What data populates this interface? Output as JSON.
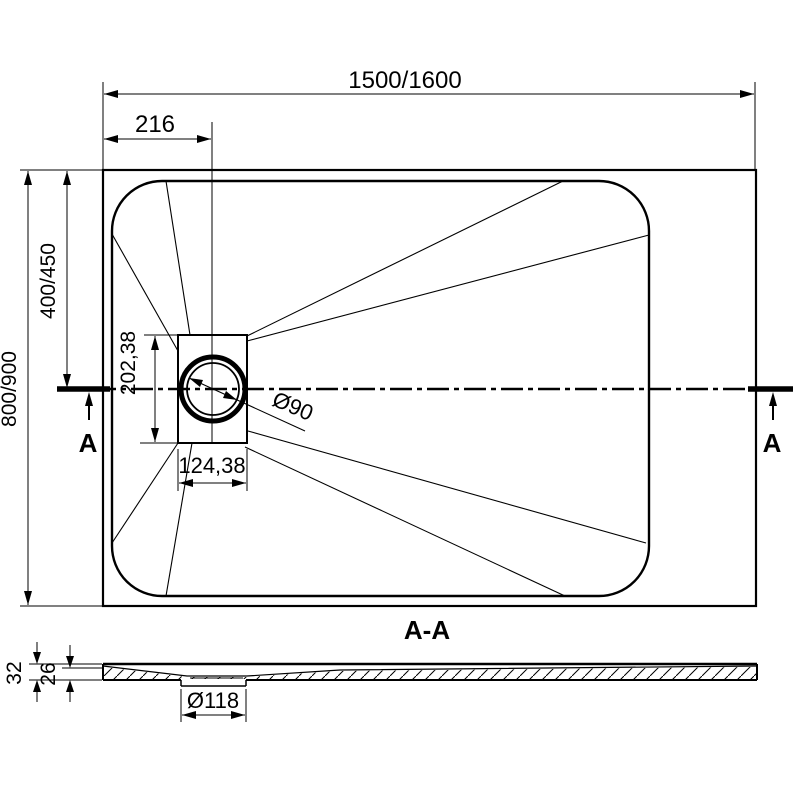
{
  "colors": {
    "line": "#000000",
    "background": "#ffffff"
  },
  "plan": {
    "overall_width_label": "1500/1600",
    "drain_offset_x_label": "216",
    "overall_depth_label": "800/900",
    "drain_axis_offset_label": "400/450",
    "drain_box_height_label": "202,38",
    "drain_box_width_label": "124,38",
    "drain_diameter_label": "Ø90",
    "section_cut_label_left": "A",
    "section_cut_label_right": "A"
  },
  "section": {
    "title": "A-A",
    "overall_thickness_label": "32",
    "bottom_thickness_label": "26",
    "drain_hole_diameter_label": "Ø118"
  }
}
